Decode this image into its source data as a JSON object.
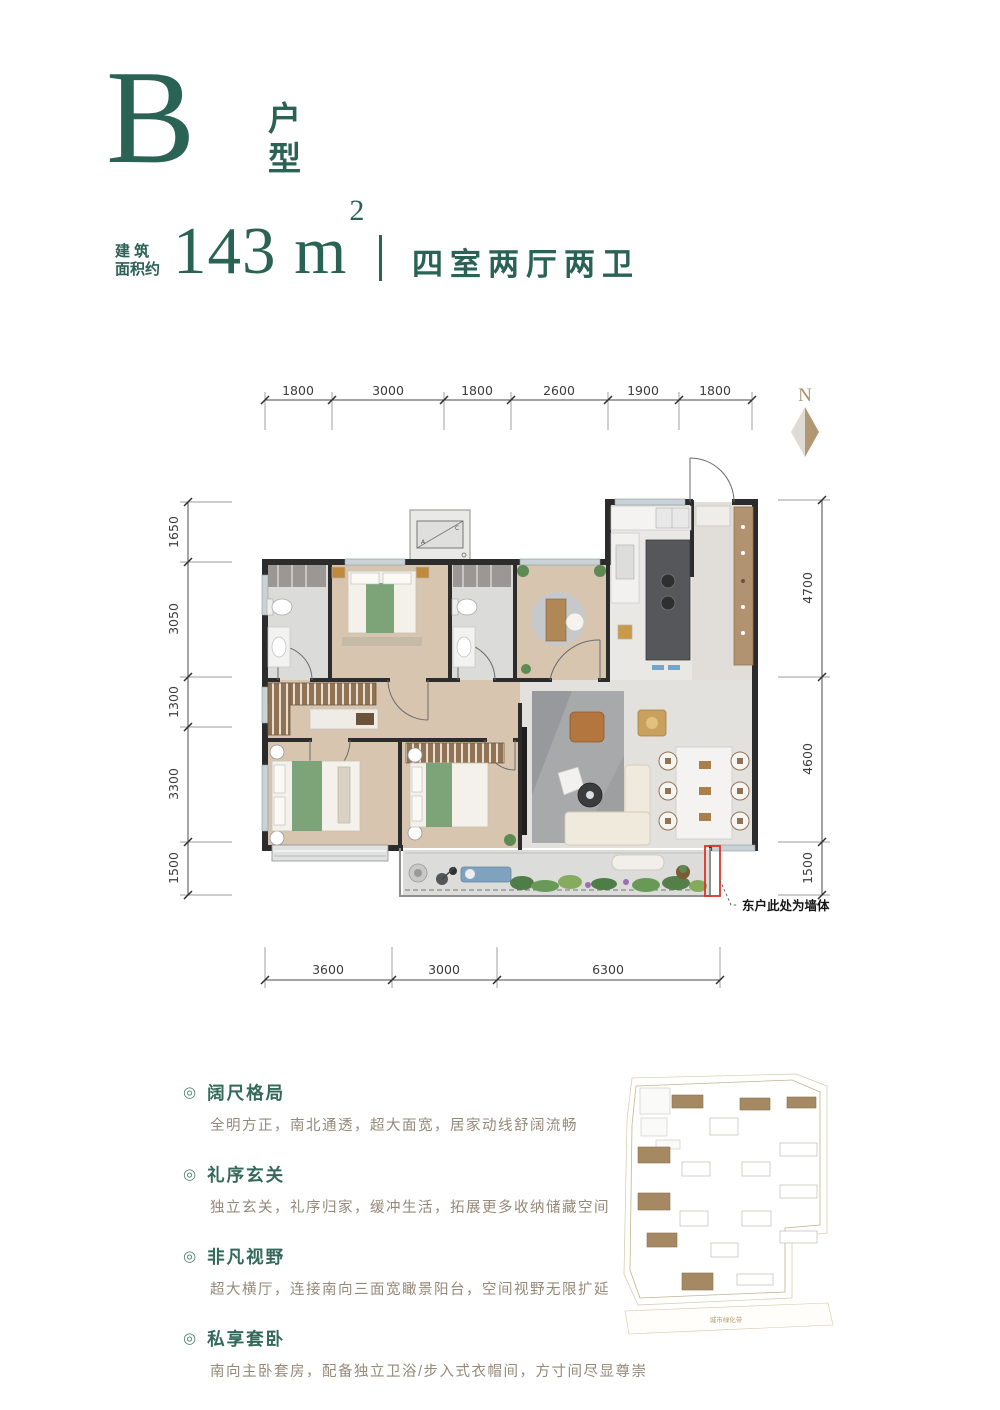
{
  "header": {
    "unit_letter": "B",
    "unit_char_1": "户",
    "unit_char_2": "型",
    "area_prefix": "建 筑\n面积约",
    "area_value": "143",
    "area_unit": " m",
    "area_exp": "2",
    "layout_text": "四室两厅两卫"
  },
  "plan": {
    "north_label": "N",
    "dims_top": [
      "1800",
      "3000",
      "1800",
      "2600",
      "1900",
      "1800"
    ],
    "dims_left": [
      "1650",
      "3050",
      "1300",
      "3300",
      "1500"
    ],
    "dims_right": [
      "4700",
      "4600",
      "1500"
    ],
    "dims_bottom": [
      "3600",
      "3000",
      "6300"
    ],
    "wall_note": "东户此处为墙体",
    "ac_label_a": "A",
    "ac_label_c": "C"
  },
  "features": [
    {
      "title": "阔尺格局",
      "desc": "全明方正，南北通透，超大面宽，居家动线舒阔流畅"
    },
    {
      "title": "礼序玄关",
      "desc": "独立玄关，礼序归家，缓冲生活，拓展更多收纳储藏空间"
    },
    {
      "title": "非凡视野",
      "desc": "超大横厅，连接南向三面宽瞰景阳台，空间视野无限扩延"
    },
    {
      "title": "私享套卧",
      "desc": "南向主卧套房，配备独立卫浴/步入式衣帽间，方寸间尽显尊崇"
    }
  ],
  "siteplan": {
    "caption": "城市绿化带",
    "buildings": [
      {
        "x": 52,
        "y": 25,
        "w": 31,
        "h": 13,
        "filled": true
      },
      {
        "x": 120,
        "y": 28,
        "w": 30,
        "h": 12,
        "filled": true
      },
      {
        "x": 167,
        "y": 27,
        "w": 29,
        "h": 11,
        "filled": true
      },
      {
        "x": 18,
        "y": 77,
        "w": 32,
        "h": 16,
        "filled": true
      },
      {
        "x": 18,
        "y": 123,
        "w": 32,
        "h": 17,
        "filled": true
      },
      {
        "x": 27,
        "y": 163,
        "w": 30,
        "h": 14,
        "filled": true
      },
      {
        "x": 62,
        "y": 203,
        "w": 31,
        "h": 17,
        "filled": true
      },
      {
        "x": 90,
        "y": 48,
        "w": 28,
        "h": 17,
        "filled": false
      },
      {
        "x": 160,
        "y": 73,
        "w": 37,
        "h": 13,
        "filled": false
      },
      {
        "x": 62,
        "y": 92,
        "w": 28,
        "h": 14,
        "filled": false
      },
      {
        "x": 122,
        "y": 92,
        "w": 28,
        "h": 14,
        "filled": false
      },
      {
        "x": 160,
        "y": 115,
        "w": 37,
        "h": 13,
        "filled": false
      },
      {
        "x": 60,
        "y": 141,
        "w": 28,
        "h": 15,
        "filled": false
      },
      {
        "x": 122,
        "y": 141,
        "w": 29,
        "h": 15,
        "filled": false
      },
      {
        "x": 160,
        "y": 161,
        "w": 37,
        "h": 12,
        "filled": false
      },
      {
        "x": 91,
        "y": 173,
        "w": 27,
        "h": 14,
        "filled": false
      },
      {
        "x": 117,
        "y": 204,
        "w": 36,
        "h": 11,
        "filled": false
      }
    ]
  },
  "colors": {
    "brand_green": "#2A6254",
    "feature_green": "#34695A",
    "accent_red": "#E03228",
    "north_tan": "#A9906B"
  }
}
